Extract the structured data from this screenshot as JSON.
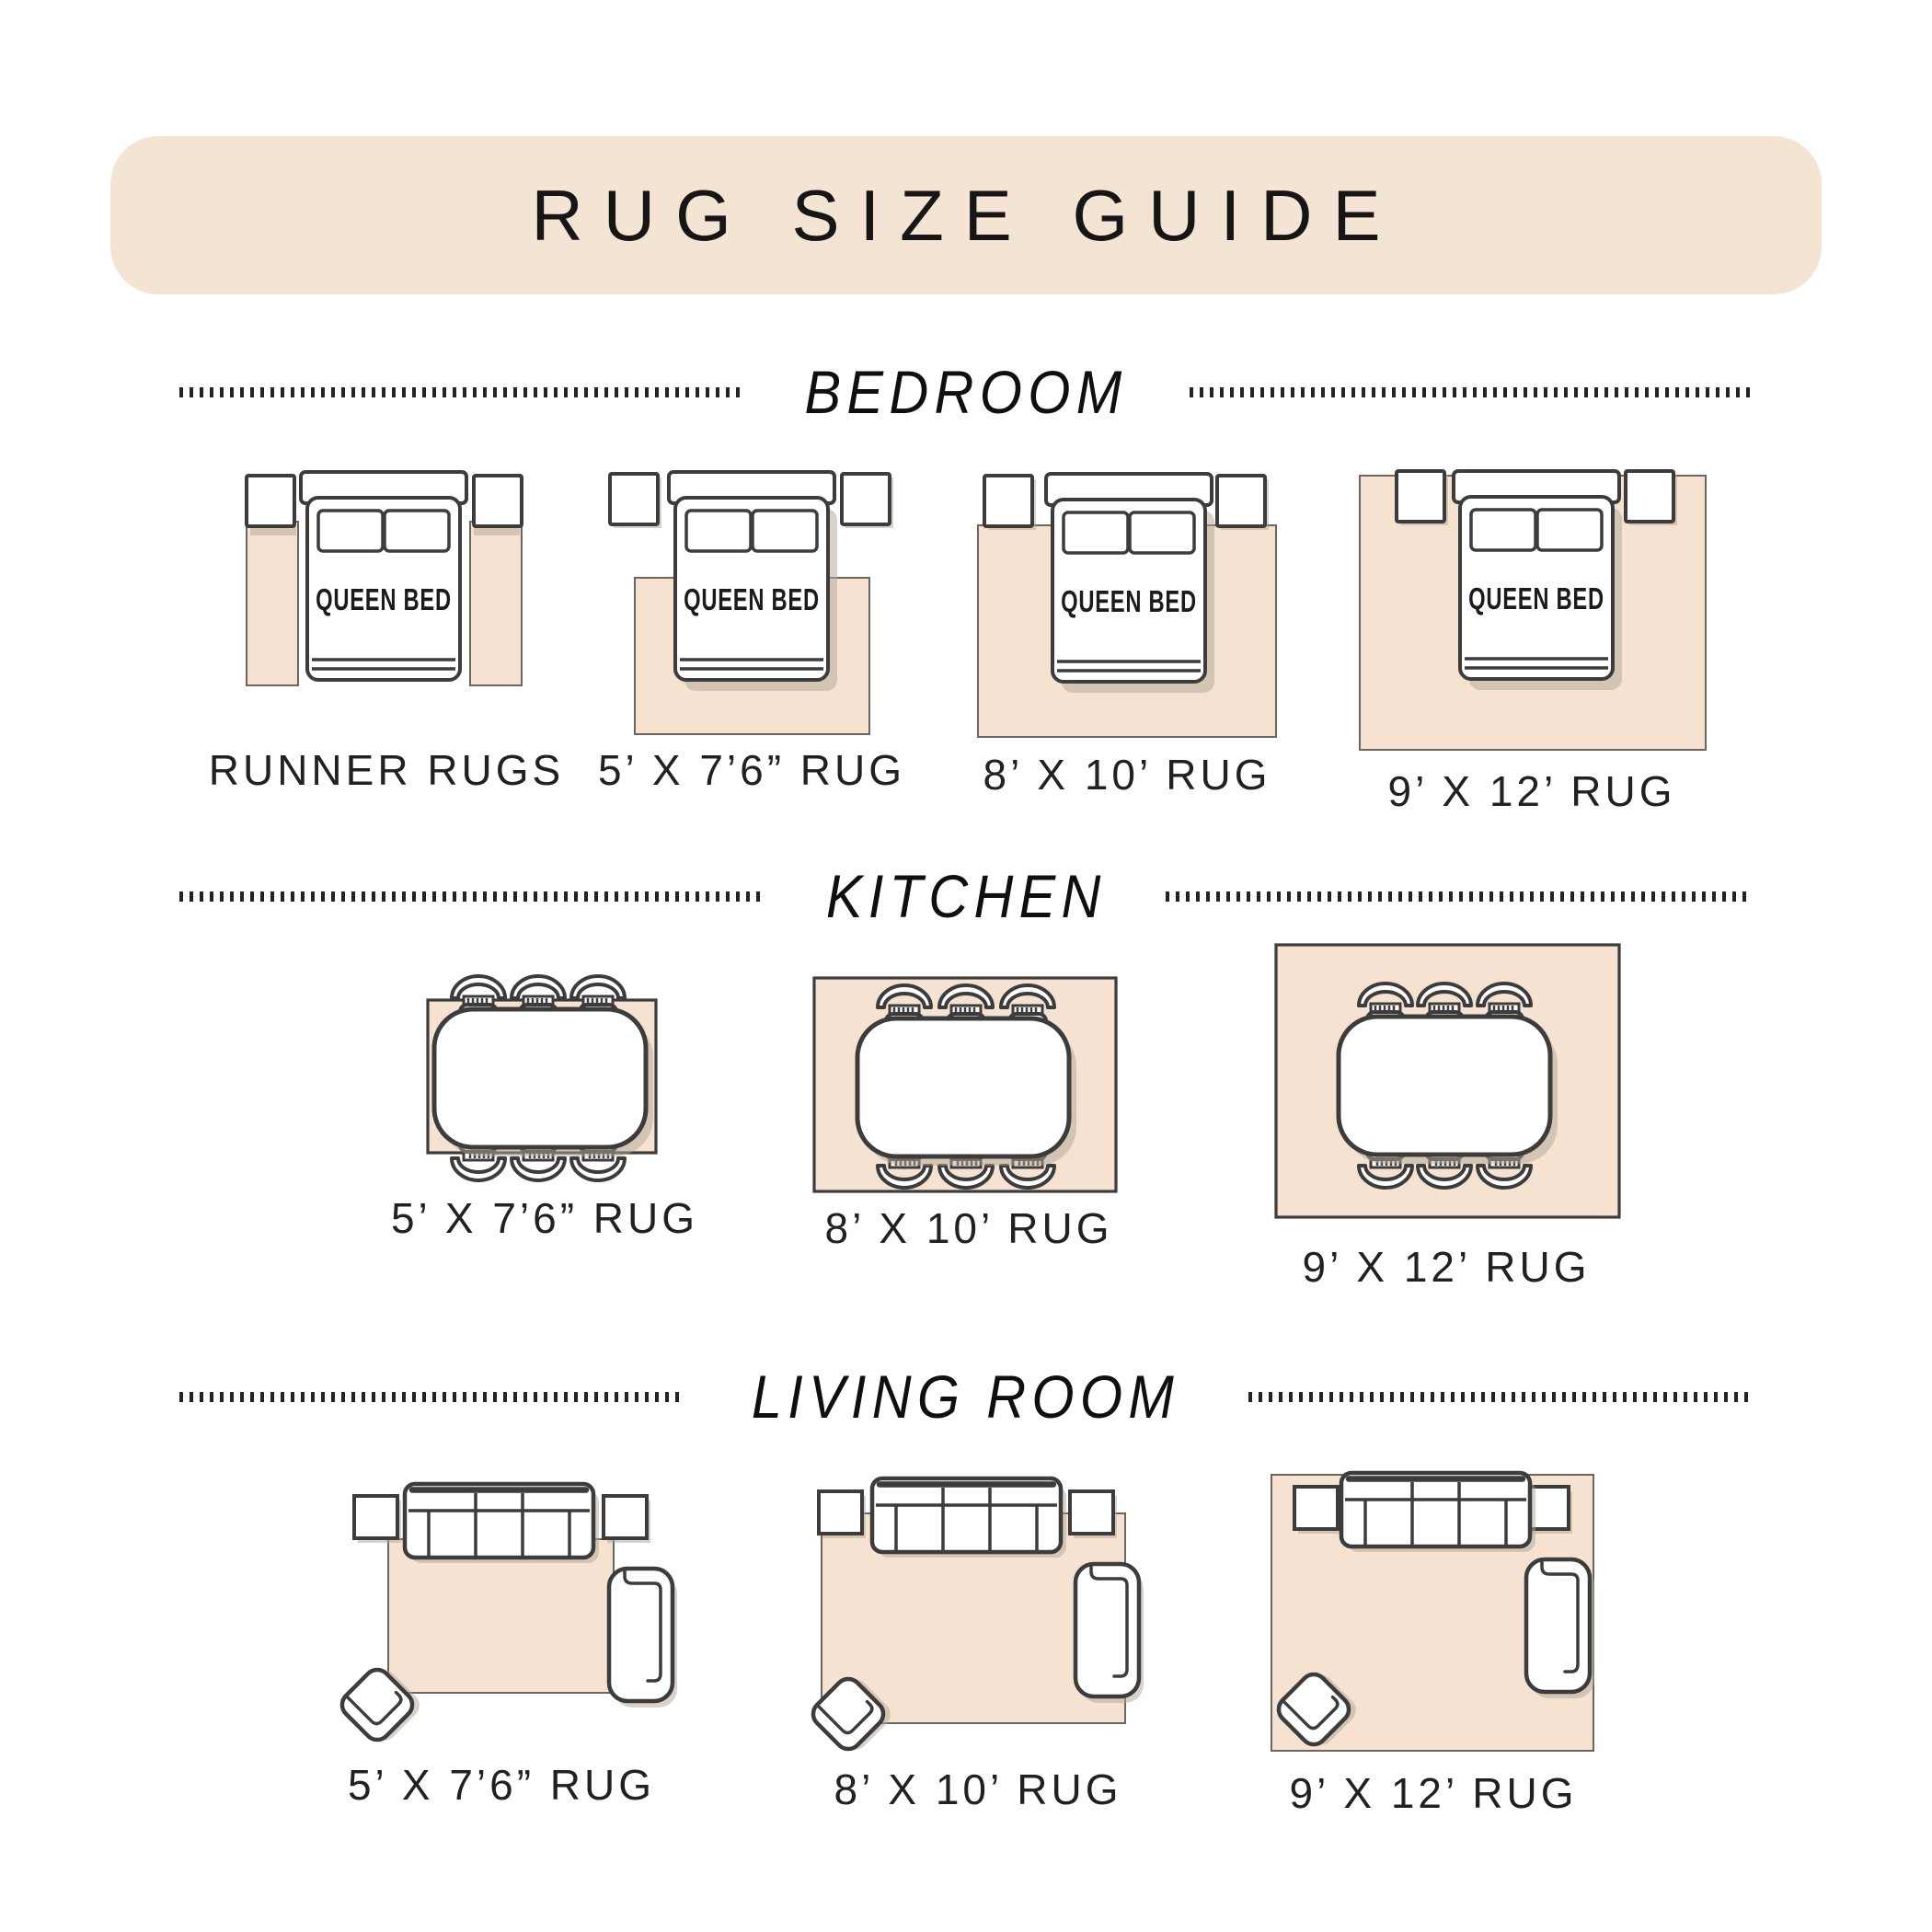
{
  "page": {
    "title": "RUG SIZE GUIDE"
  },
  "colors": {
    "banner_bg": "#f4e4d3",
    "rug": "#f5e2d0",
    "outline": "#3c3c3c",
    "shadow": "#b4a596"
  },
  "sections": [
    {
      "title": "BEDROOM",
      "items": [
        {
          "label": "RUNNER RUGS",
          "furniture_label": "QUEEN BED"
        },
        {
          "label": "5’ X 7’6” RUG",
          "furniture_label": "QUEEN BED"
        },
        {
          "label": "8’ X 10’ RUG",
          "furniture_label": "QUEEN BED"
        },
        {
          "label": "9’ X 12’ RUG",
          "furniture_label": "QUEEN BED"
        }
      ]
    },
    {
      "title": "KITCHEN",
      "items": [
        {
          "label": "5’ X 7’6” RUG"
        },
        {
          "label": "8’ X 10’ RUG"
        },
        {
          "label": "9’ X 12’ RUG"
        }
      ]
    },
    {
      "title": "LIVING ROOM",
      "items": [
        {
          "label": "5’ X 7’6” RUG"
        },
        {
          "label": "8’ X 10’ RUG"
        },
        {
          "label": "9’ X 12’ RUG"
        }
      ]
    }
  ]
}
